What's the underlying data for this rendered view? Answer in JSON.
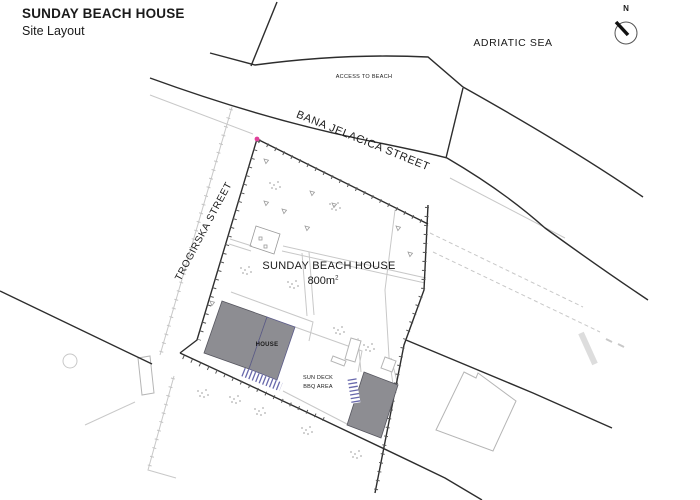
{
  "header": {
    "title_line1": "SUNDAY BEACH HOUSE",
    "title_line2": "Site Layout"
  },
  "labels": {
    "sea": "ADRIATIC SEA",
    "north_letter": "N",
    "access_to_beach": "ACCESS TO BEACH",
    "street_main": "BANA JELACICA STREET",
    "street_side": "TROGIRSKA STREET",
    "site_name": "SUNDAY BEACH HOUSE",
    "site_area": "800m",
    "site_area_sup": "2",
    "house": "HOUSE",
    "deck_line1": "SUN DECK",
    "deck_line2": "BBQ AREA"
  },
  "colors": {
    "line_dark": "#2d2d2d",
    "line_light": "#c8c8c8",
    "tick_dark": "#555555",
    "building_fill": "#8d8d92",
    "building_edge": "#55555e",
    "stair_blue": "#6868ac",
    "corner_pink": "#e0409a"
  }
}
